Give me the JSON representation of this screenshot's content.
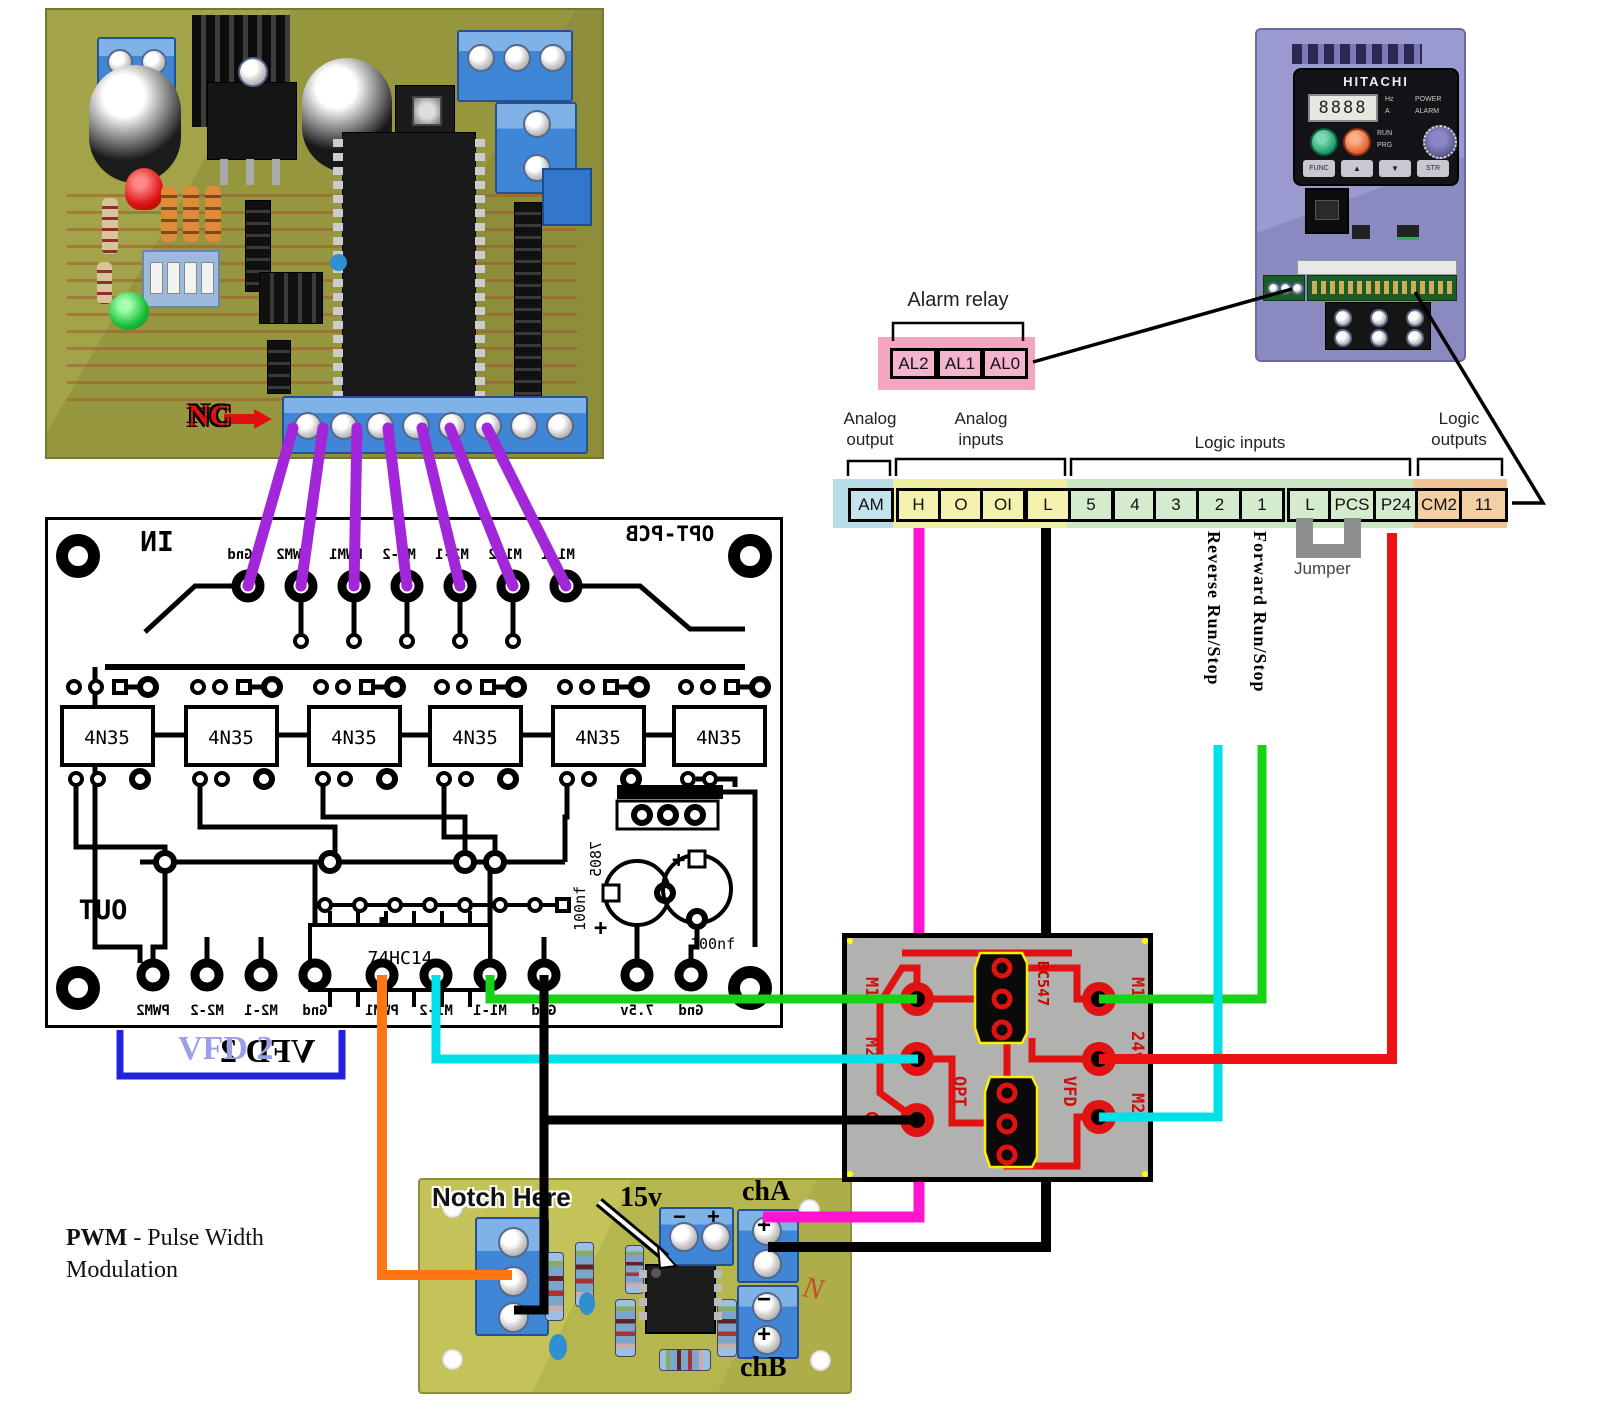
{
  "photo_board": {
    "nc_label": "NC"
  },
  "opt_pcb": {
    "in_label": "IN",
    "title": "OPT-PCB",
    "out_label": "OUT",
    "top_pads": [
      "Gnd",
      "PWM2",
      "PWM1",
      "M2-2",
      "M2-1",
      "M1-2",
      "M1-1"
    ],
    "bottom_pads": [
      "PWM2",
      "M2-2",
      "M2-1",
      "Gnd",
      "PWM1",
      "M1-2",
      "M1-1",
      "Gnd",
      "7.5v",
      "Gnd"
    ],
    "opto_label": "4N35",
    "ic_label": "74HC14",
    "regulator_label": "7805",
    "cap_label": "100nf",
    "plus": "+",
    "vfd2_label": "VFD 2"
  },
  "vfd_unit": {
    "brand": "HITACHI",
    "display": "8888",
    "hz": "Hz",
    "amp": "A",
    "power": "POWER",
    "alarm": "ALARM",
    "run": "RUN",
    "prg": "PRG",
    "func": "FUNC",
    "up": "▲",
    "down": "▼",
    "str": "STR"
  },
  "alarm_relay": {
    "label": "Alarm relay",
    "terminals": [
      "AL2",
      "AL1",
      "AL0"
    ]
  },
  "terminal_strip": {
    "groups": [
      {
        "label": "Analog output",
        "terminals": [
          "AM"
        ]
      },
      {
        "label": "Analog inputs",
        "terminals": [
          "H",
          "O",
          "OI",
          "L"
        ]
      },
      {
        "label": "Logic inputs",
        "terminals": [
          "5",
          "4",
          "3",
          "2",
          "1",
          "L",
          "PCS",
          "P24"
        ]
      },
      {
        "label": "Logic outputs",
        "terminals": [
          "CM2",
          "11"
        ]
      }
    ],
    "jumper_label": "Jumper",
    "reverse_label": "Reverse Run/Stop",
    "forward_label": "Forward Run/Stop"
  },
  "adapter_board": {
    "opt_side": "OPT",
    "vfd_side": "VFD",
    "left_pins": [
      "M1",
      "M2",
      "G"
    ],
    "right_pins": [
      "M1",
      "24v",
      "M2"
    ],
    "transistor": "BC547"
  },
  "driver_board": {
    "notch_label": "Notch Here",
    "voltage_label": "15v",
    "channel_a": "chA",
    "channel_b": "chB",
    "plus": "+",
    "minus": "−",
    "marking": "N"
  },
  "pwm_note": {
    "term": "PWM",
    "definition": " - Pulse Width",
    "line2": "Modulation"
  },
  "wire_colors": {
    "purple": "#a227da",
    "magenta": "#ff14cf",
    "cyan": "#00e0e8",
    "green": "#16d316",
    "red": "#ee1212",
    "orange": "#ff7712",
    "black": "#000000",
    "bracket_blue": "#2222dd",
    "nc_red": "#e11111",
    "pink_box": "#f2a6c2"
  }
}
